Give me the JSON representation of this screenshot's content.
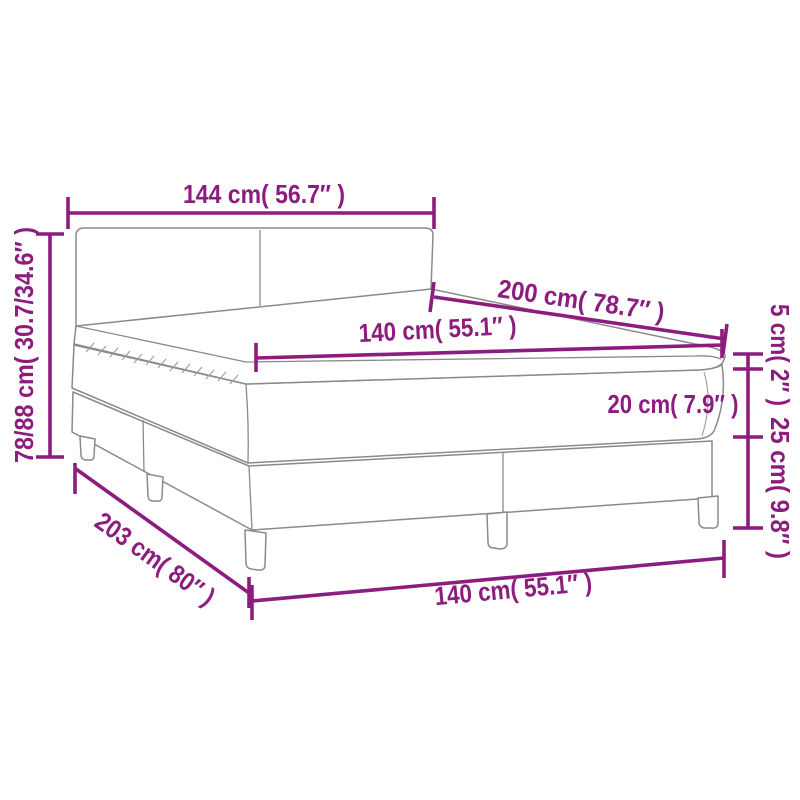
{
  "page": {
    "background": "#ffffff",
    "description": "Dimension diagram of a box spring bed with headboard, mattress topper, mattress and slatted base with legs"
  },
  "diagram": {
    "colors": {
      "dimension_accent": "#8C1D7F",
      "outline_gray": "#8A8A8A",
      "background": "#ffffff"
    },
    "dimensions": [
      {
        "id": "headboard-width",
        "label": "144 cm( 56.7″ )",
        "cm": "144",
        "inches": "56.7",
        "location": "top-horizontal"
      },
      {
        "id": "overall-height",
        "label": "78/88 cm( 30.7/34.6″ )",
        "cm": "78/88",
        "inches": "30.7/34.6",
        "location": "left-vertical"
      },
      {
        "id": "bed-length",
        "label": "200 cm( 78.7″ )",
        "cm": "200",
        "inches": "78.7",
        "location": "upper-right-diagonal"
      },
      {
        "id": "mattress-width",
        "label": "140 cm( 55.1″ )",
        "cm": "140",
        "inches": "55.1",
        "location": "on-mattress-top"
      },
      {
        "id": "mattress-height",
        "label": "20 cm( 7.9″ )",
        "cm": "20",
        "inches": "7.9",
        "location": "mattress-side"
      },
      {
        "id": "topper-height",
        "label": "5 cm( 2″ )",
        "cm": "5",
        "inches": "2",
        "location": "right-vertical"
      },
      {
        "id": "base-height",
        "label": "25 cm( 9.8″ )",
        "cm": "25",
        "inches": "9.8",
        "location": "right-vertical"
      },
      {
        "id": "base-length",
        "label": "203 cm( 80″ )",
        "cm": "203",
        "inches": "80",
        "location": "lower-left-diagonal"
      },
      {
        "id": "base-width",
        "label": "140 cm( 55.1″ )",
        "cm": "140",
        "inches": "55.1",
        "location": "bottom-horizontal"
      }
    ]
  }
}
